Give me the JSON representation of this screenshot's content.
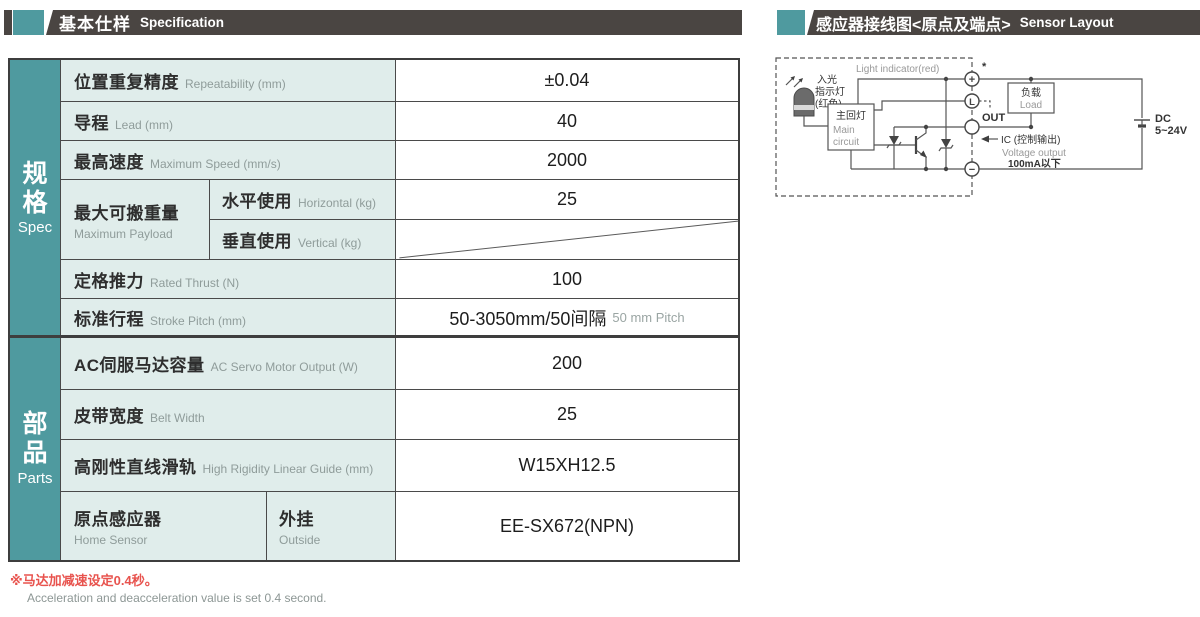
{
  "colors": {
    "accent_teal": "#4f9a9f",
    "header_dark": "#4a4542",
    "cell_bg": "#e0edeb",
    "border": "#3e3e3e",
    "note_red": "#e8534e",
    "sub_text_gray": "#8f9c9a"
  },
  "header_left": {
    "title_cn": "基本仕样",
    "title_en": "Specification"
  },
  "header_right": {
    "title_cn": "感应器接线图<原点及端点>",
    "title_en": "Sensor Layout"
  },
  "table": {
    "groups": [
      {
        "cn": "规格",
        "en": "Spec"
      },
      {
        "cn": "部品",
        "en": "Parts"
      }
    ],
    "rows": [
      {
        "cn": "位置重复精度",
        "en": "Repeatability (mm)",
        "value": "±0.04"
      },
      {
        "cn": "导程",
        "en": "Lead (mm)",
        "value": "40"
      },
      {
        "cn": "最高速度",
        "en": "Maximum Speed (mm/s)",
        "value": "2000"
      },
      {
        "cn": "最大可搬重量",
        "en": "Maximum Payload",
        "sub": [
          {
            "cn": "水平使用",
            "en": "Horizontal (kg)",
            "value": "25"
          },
          {
            "cn": "垂直使用",
            "en": "Vertical (kg)",
            "value": ""
          }
        ]
      },
      {
        "cn": "定格推力",
        "en": "Rated Thrust (N)",
        "value": "100"
      },
      {
        "cn": "标准行程",
        "en": "Stroke Pitch (mm)",
        "value": "50-3050mm/50间隔",
        "value_en": "50 mm Pitch"
      },
      {
        "cn": "AC伺服马达容量",
        "en": "AC Servo Motor Output (W)",
        "value": "200"
      },
      {
        "cn": "皮带宽度",
        "en": "Belt Width",
        "value": "25"
      },
      {
        "cn": "高刚性直线滑轨",
        "en": "High Rigidity Linear Guide (mm)",
        "value": "W15XH12.5"
      },
      {
        "cn": "原点感应器",
        "en": "Home Sensor",
        "sub_cn": "外挂",
        "sub_en": "Outside",
        "value": "EE-SX672(NPN)"
      }
    ]
  },
  "notes": {
    "cn": "※马达加减速设定0.4秒。",
    "en": "Acceleration and deacceleration value is set 0.4 second."
  },
  "diagram": {
    "light_indicator_en": "Light indicator(red)",
    "light_in": "入光",
    "indicator": "指示灯",
    "red_color": "(红色)",
    "main_circuit_cn": "主回灯",
    "main_en_1": "Main",
    "main_en_2": "circuit",
    "load_cn": "负载",
    "load_en": "Load",
    "out_label": "OUT",
    "ic_label": "IC (控制输出)",
    "voltage_output": "Voltage output",
    "current_limit": "100mA以下",
    "dc_label": "DC",
    "dc_range": "5~24V",
    "terminal_plus": "+",
    "terminal_l": "L",
    "terminal_minus": "−",
    "asterisk": "*"
  }
}
